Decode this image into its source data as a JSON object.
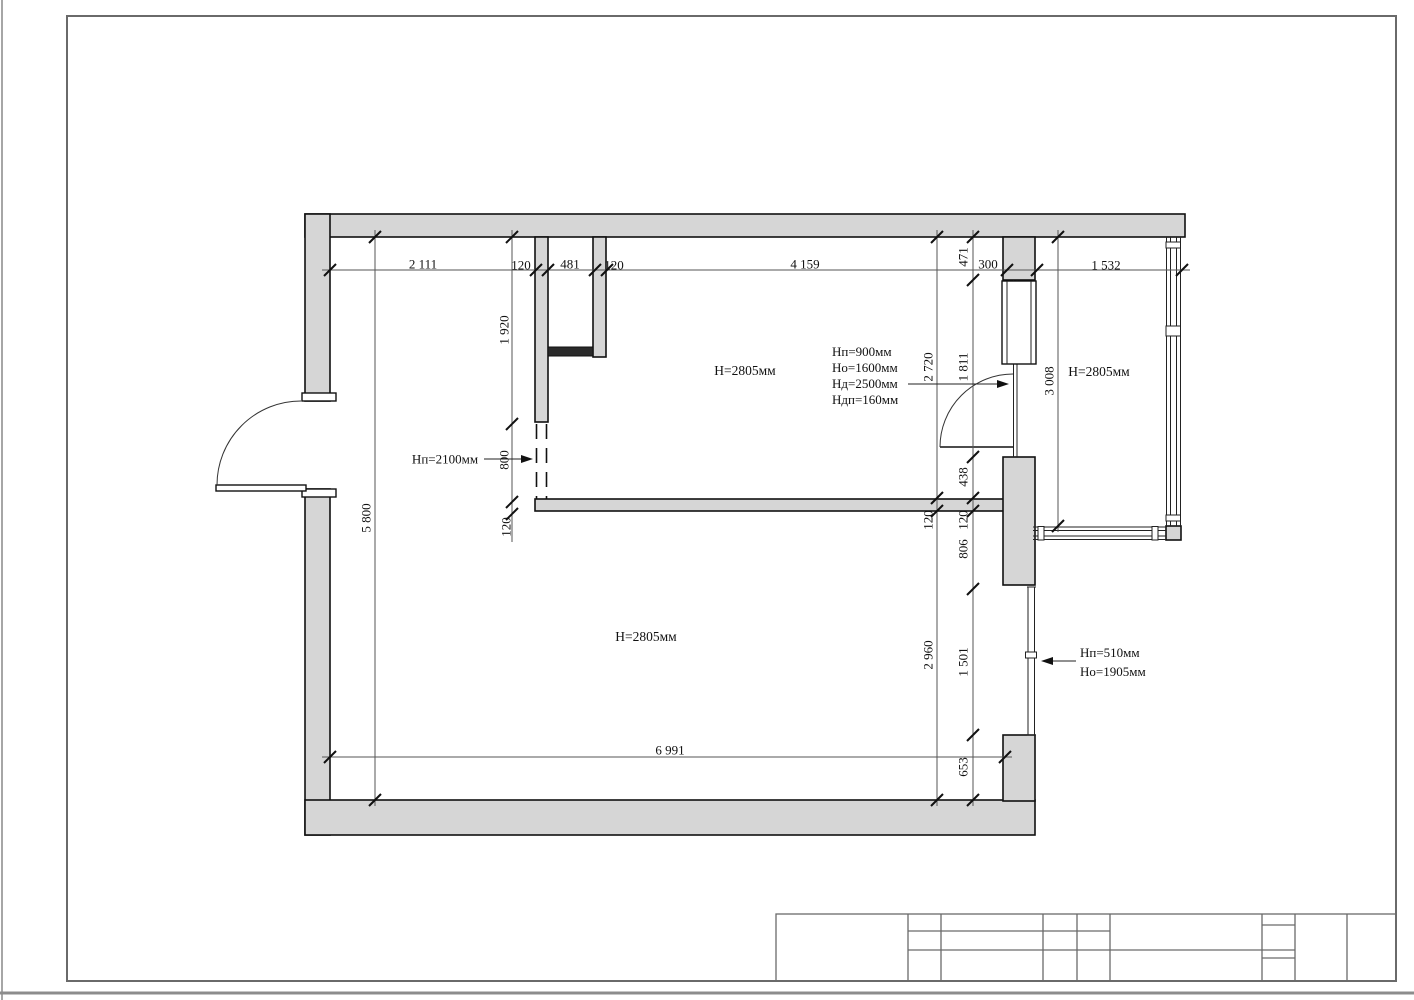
{
  "drawing": {
    "dims": {
      "top_chain": [
        "2 111",
        "120",
        "481",
        "120",
        "4 159",
        "300",
        "1 532"
      ],
      "left_chain": [
        "1 920",
        "800",
        "120"
      ],
      "left_overall": "5 800",
      "mid_chain": [
        "2 720",
        "120",
        "2 960"
      ],
      "right_chain": [
        "471",
        "1 811",
        "438",
        "120",
        "806",
        "1 501",
        "653"
      ],
      "balcony_height_dim": "3 008",
      "bottom_overall": "6 991"
    },
    "labels": {
      "room1_ceiling": "Н=2805мм",
      "balcony_ceiling": "Н=2805мм",
      "room2_ceiling": "Н=2805мм",
      "opening_note": "Нп=2100мм",
      "door_note": [
        "Нп=900мм",
        "Но=1600мм",
        "Нд=2500мм",
        "Ндп=160мм"
      ],
      "window_note": [
        "Нп=510мм",
        "Но=1905мм"
      ]
    },
    "colors": {
      "wall_fill": "#d6d6d6",
      "outline": "#111111",
      "dim_line": "#555555",
      "frame_line": "#6a6a6a"
    }
  },
  "title_block": {
    "text": ""
  }
}
